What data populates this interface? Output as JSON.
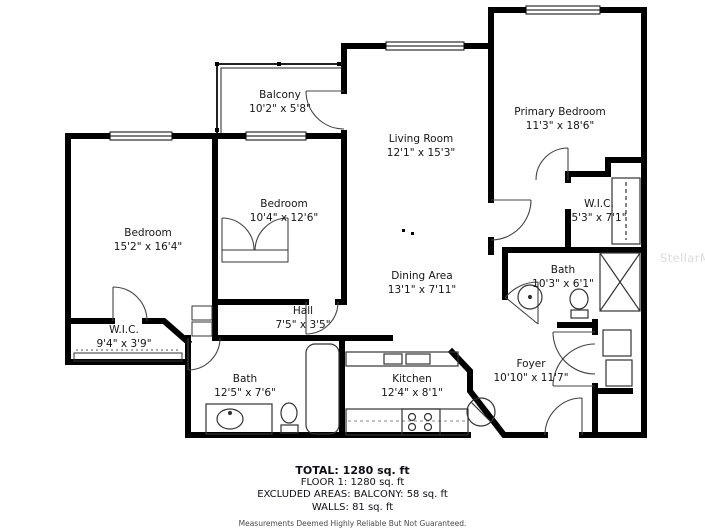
{
  "watermark": "StellarMLS",
  "rooms": [
    {
      "name": "Balcony",
      "dims": "10'2\" x 5'8\""
    },
    {
      "name": "Living Room",
      "dims": "12'1\" x 15'3\""
    },
    {
      "name": "Primary Bedroom",
      "dims": "11'3\" x 18'6\""
    },
    {
      "name": "Bedroom",
      "dims": "10'4\" x 12'6\""
    },
    {
      "name": "Bedroom",
      "dims": "15'2\" x 16'4\""
    },
    {
      "name": "W.I.C.",
      "dims": "5'3\" x 7'1\""
    },
    {
      "name": "Bath",
      "dims": "10'3\" x 6'1\""
    },
    {
      "name": "Dining Area",
      "dims": "13'1\" x 7'11\""
    },
    {
      "name": "Hall",
      "dims": "7'5\" x 3'5\""
    },
    {
      "name": "W.I.C.",
      "dims": "9'4\" x 3'9\""
    },
    {
      "name": "Bath",
      "dims": "12'5\" x 7'6\""
    },
    {
      "name": "Kitchen",
      "dims": "12'4\" x 8'1\""
    },
    {
      "name": "Foyer",
      "dims": "10'10\" x 11'7\""
    }
  ],
  "footer": {
    "total": "TOTAL: 1280 sq. ft",
    "floor": "FLOOR 1: 1280 sq. ft",
    "excluded": "EXCLUDED AREAS: BALCONY: 58 sq. ft",
    "walls": "WALLS: 81 sq. ft",
    "disclaimer": "Measurements Deemed Highly Reliable But Not Guaranteed."
  }
}
